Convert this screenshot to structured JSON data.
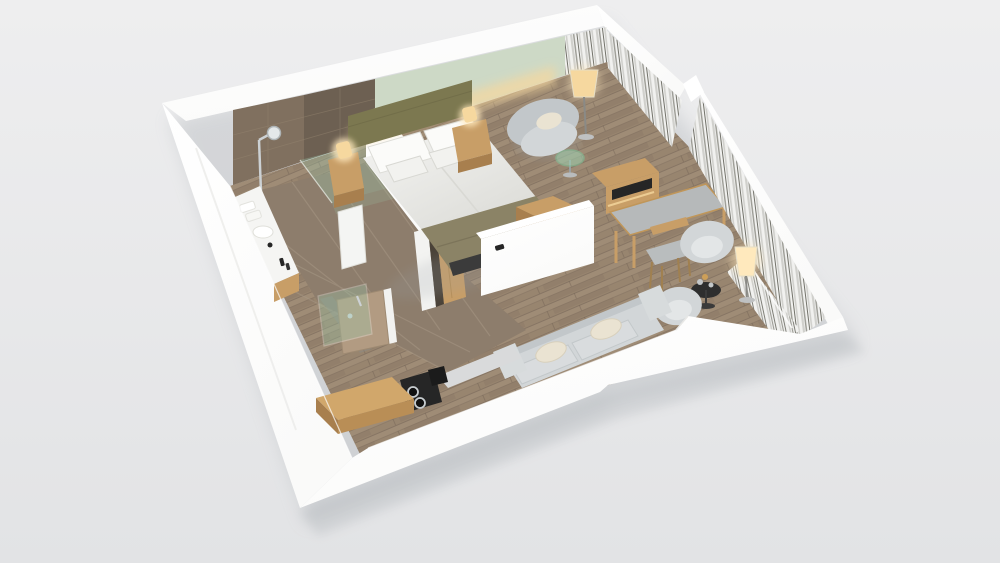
{
  "scene": {
    "description": "photorealistic 3d cutaway dollhouse render of a studio hotel room floor plan on a plain light gray backdrop, viewed from above at an angle",
    "rooms": [
      "bedroom-living-area",
      "bathroom",
      "entry-corridor",
      "lounge-corner"
    ],
    "objects": [
      "double-bed-with-olive-headboard",
      "white-duvet",
      "olive-runner-blanket",
      "nightstand-left-with-lamp",
      "nightstand-right-with-lamp",
      "sage-green-accent-wall",
      "gray-armchair",
      "floor-lamp-by-armchair",
      "green-glass-side-table",
      "tv-media-console",
      "white-partition-cabinet",
      "wood-bench-cube",
      "writing-desk",
      "wooden-desk-chair",
      "curtained-window-wall",
      "tub-chair-one",
      "tub-chair-two",
      "round-drinks-table-with-decanter",
      "glowing-floor-lamp-east",
      "sliced-sofa-with-cream-pillows",
      "kitchenette-wood-table",
      "black-coffee-machine",
      "entry-door-tan",
      "bathroom-glass-door",
      "walk-in-shower",
      "shower-glass-panel",
      "white-vanity-with-sink",
      "vanity-wood-cabinet",
      "mirror-panel",
      "wardrobe-with-oak-door",
      "taupe-tile-floor",
      "oak-plank-floor",
      "white-cutaway-walls"
    ]
  },
  "palette": {
    "background_top": "#eeeeef",
    "background_bottom": "#e2e3e5",
    "shadow": "#9aa0a6",
    "wall_white": "#fafaf9",
    "wall_bright": "#ffffff",
    "wall_shade": "#ededec",
    "floor_wood": "#98856f",
    "plank_light": "#a6937e",
    "plank_dark": "#897663",
    "plank_seam": "#6e5f51",
    "tile_floor": "#8d7d6c",
    "tile_grout": "#a79885",
    "tile_wall": "#80705f",
    "tile_wall_dark": "#6d6052",
    "accent_green": "#cdd9c6",
    "headboard_olive": "#7c7850",
    "blanket_olive": "#8b8366",
    "linen_white": "#f5f5f3",
    "linen_shadow": "#d7d7d2",
    "oak": "#c89e67",
    "oak_dark": "#a87f4e",
    "gray_fabric": "#d2d6d8",
    "gray_fabric_dark": "#c2c7ca",
    "cushion_cream": "#eae3d2",
    "curtain_light": "#f1f1ef",
    "curtain_mid": "#d0d0cc",
    "curtain_dark": "#9b9b94",
    "curtain_deep": "#72726a",
    "glass_green": "#9ed2b2",
    "lamp_glow": "#f6d89f",
    "lamp_glow_strong": "#ffe9bd",
    "dark_appliance": "#262626",
    "chrome": "#ccd1d4",
    "door_tan": "#b29b82",
    "desk_top": "#b6b9ba",
    "bed_base_dark": "#3b3b3b"
  }
}
